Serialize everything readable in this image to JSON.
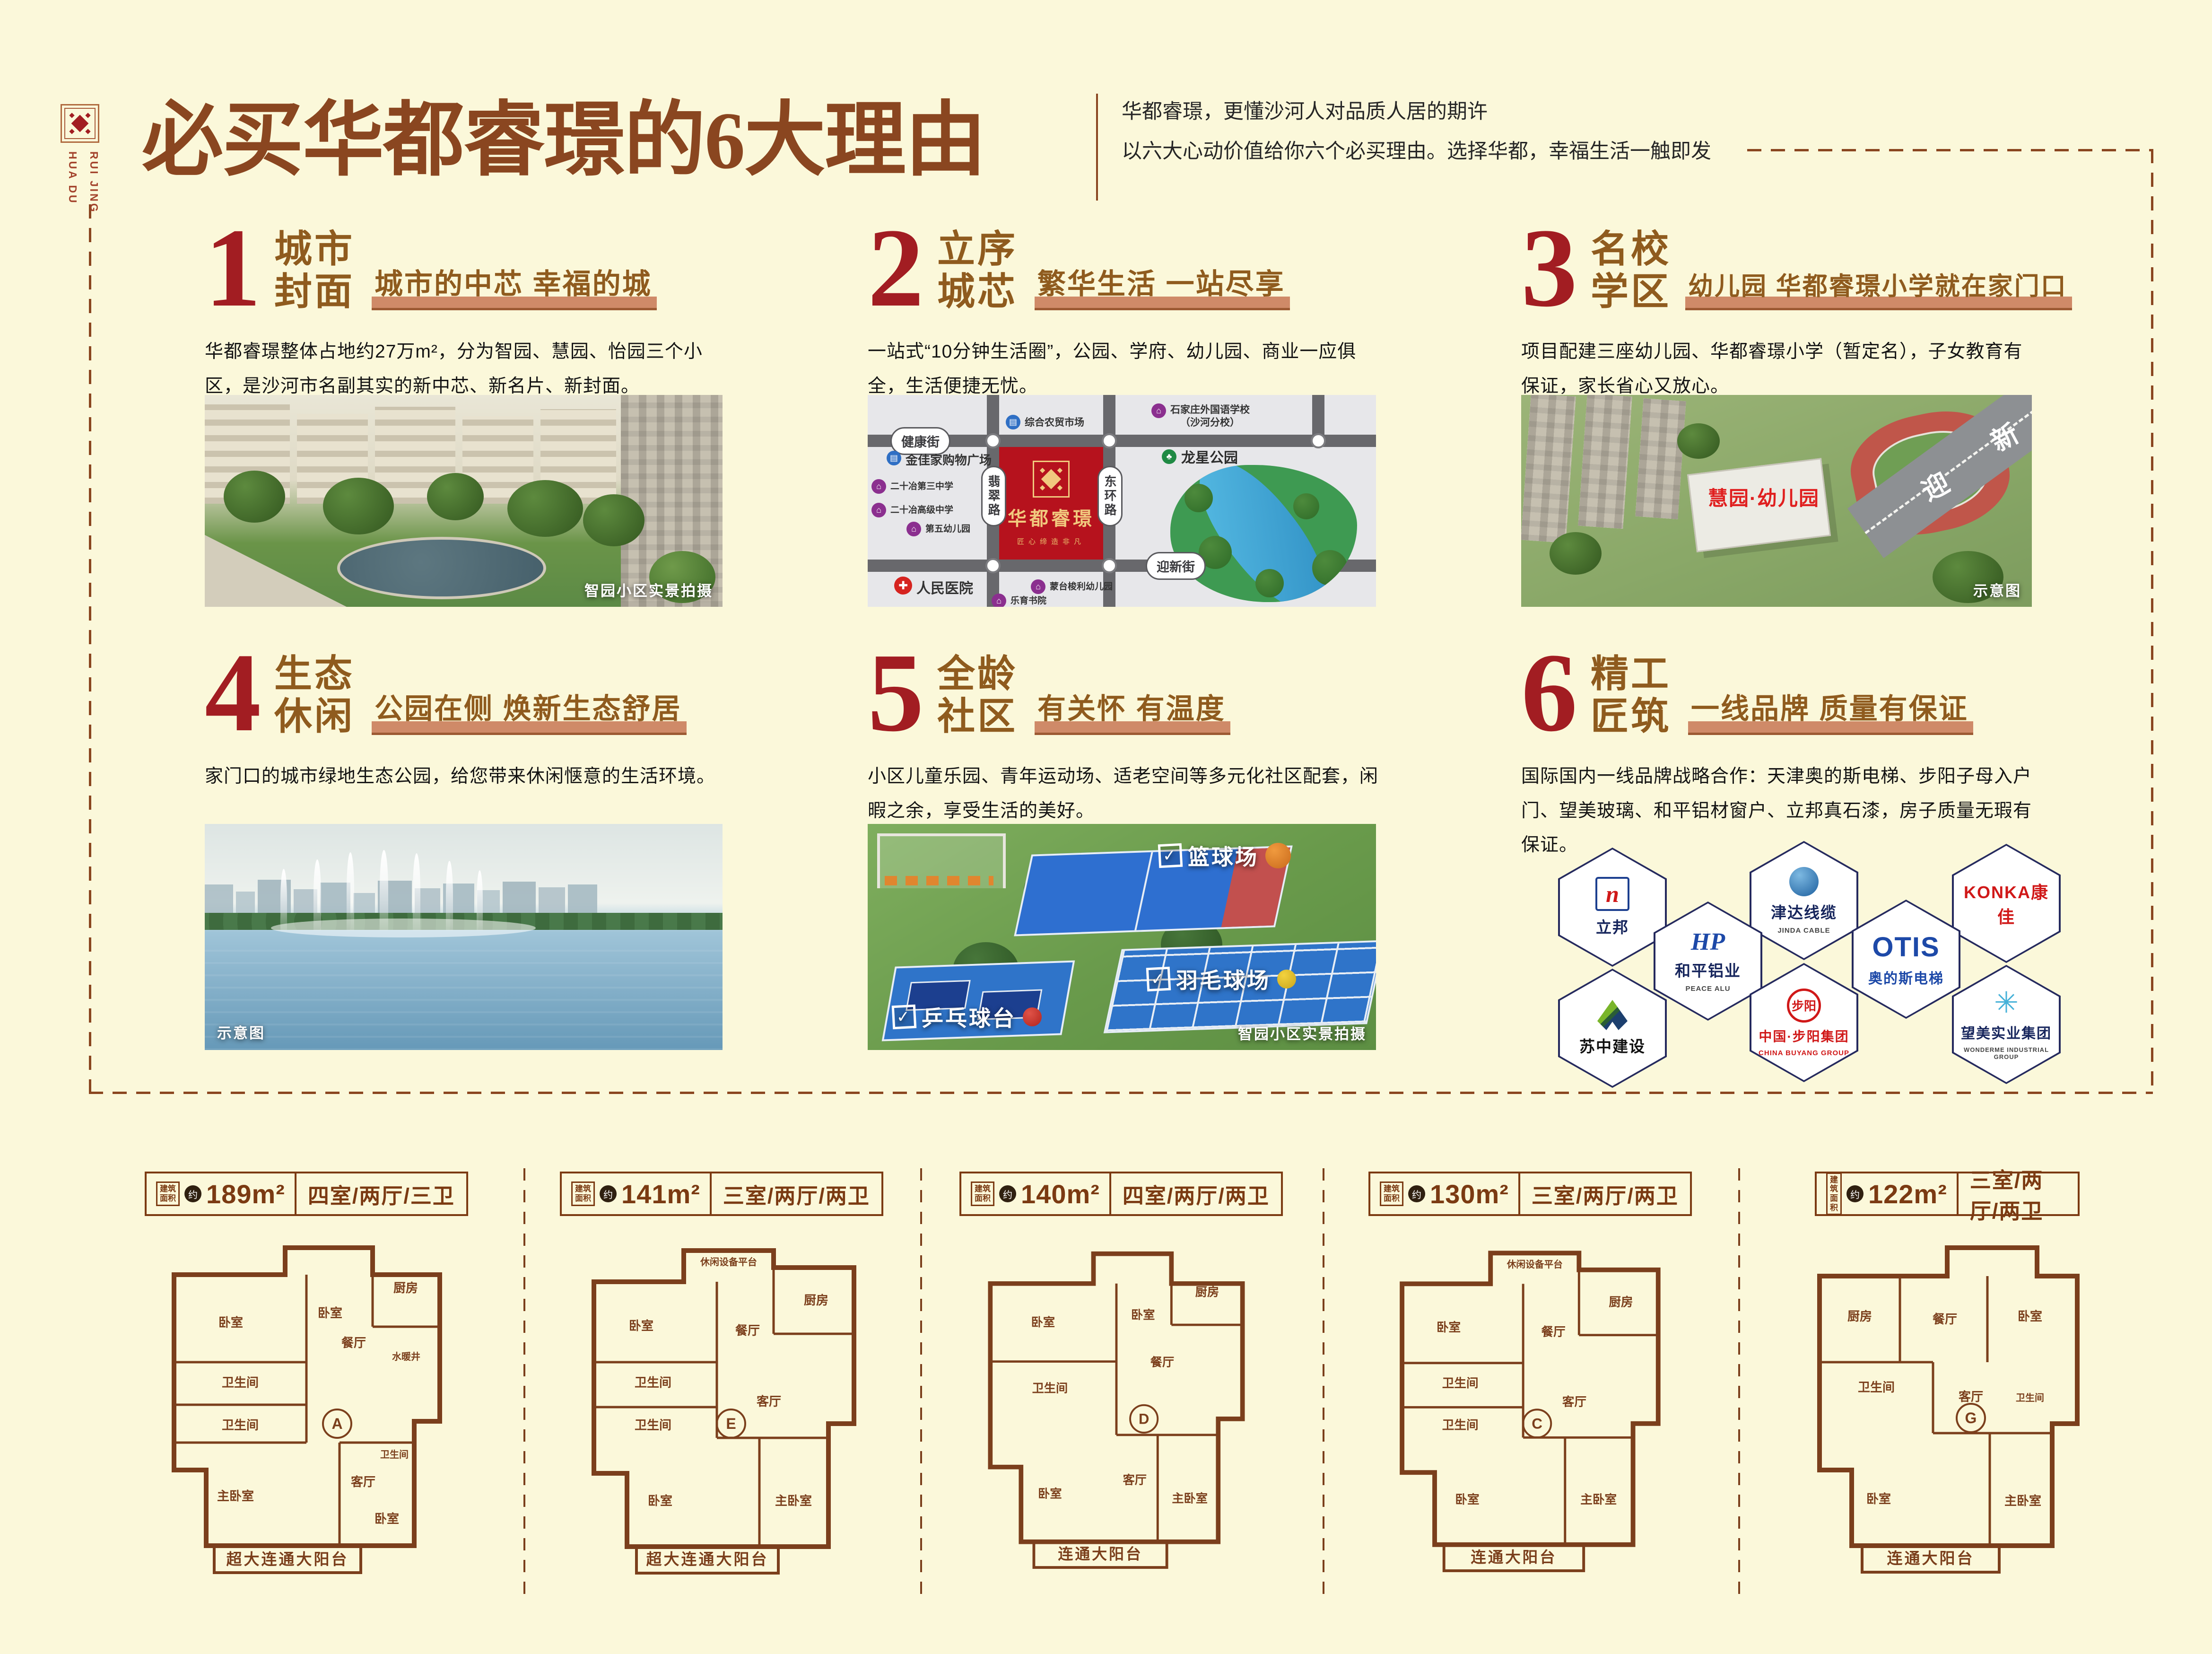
{
  "page": {
    "background": "#fbf8da"
  },
  "brand": {
    "emblem_icon": "huadu-emblem",
    "vertical_name_line1": "HUA DU",
    "vertical_name_line2": "RUI JING"
  },
  "header": {
    "title": "必买华都睿璟的6大理由",
    "subtitle_line1": "华都睿璟，更懂沙河人对品质人居的期许",
    "subtitle_line2": "以六大心动价值给你六个必买理由。选择华都，幸福生活一触即发"
  },
  "icons": {
    "market": "▤",
    "school": "⌂",
    "hospital": "✚",
    "park": "♣",
    "check": "✓"
  },
  "colors": {
    "accent_red": "#a21d22",
    "brown": "#8a4620",
    "gold_brown": "#8f5b1e",
    "bar_salmon": "#cf8a68",
    "map_red": "#b6121d",
    "plan_brown": "#7b3f1c"
  },
  "sections": [
    {
      "num": "1",
      "title1": "城市",
      "title2": "封面",
      "tagline": "城市的中芯 幸福的城",
      "body": "华都睿璟整体占地约27万m²，分为智园、慧园、怡园三个小区，是沙河市名副其实的新中芯、新名片、新封面。",
      "caption": "智园小区实景拍摄"
    },
    {
      "num": "2",
      "title1": "立序",
      "title2": "城芯",
      "tagline": "繁华生活 一站尽享",
      "body": "一站式“10分钟生活圈”，公园、学府、幼儿园、商业一应俱全，生活便捷无忧。"
    },
    {
      "num": "3",
      "title1": "名校",
      "title2": "学区",
      "tagline": "幼儿园 华都睿璟小学就在家门口",
      "body": "项目配建三座幼儿园、华都睿璟小学（暂定名），子女教育有保证，家长省心又放心。",
      "caption": "示意图",
      "building_label": "慧园·幼儿园",
      "road_char1": "迎",
      "road_char2": "新",
      "road_char3": "街"
    },
    {
      "num": "4",
      "title1": "生态",
      "title2": "休闲",
      "tagline": "公园在侧 焕新生态舒居",
      "body": "家门口的城市绿地生态公园，给您带来休闲惬意的生活环境。",
      "caption": "示意图"
    },
    {
      "num": "5",
      "title1": "全龄",
      "title2": "社区",
      "tagline": "有关怀 有温度",
      "body": "小区儿童乐园、青年运动场、适老空间等多元化社区配套，闲暇之余，享受生活的美好。",
      "caption": "智园小区实景拍摄",
      "court_labels": [
        "篮球场",
        "羽毛球场",
        "乒乓球台"
      ]
    },
    {
      "num": "6",
      "title1": "精工",
      "title2": "匠筑",
      "tagline": "一线品牌 质量有保证",
      "body": "国际国内一线品牌战略合作：天津奥的斯电梯、步阳子母入户门、望美玻璃、和平铝材窗户、立邦真石漆，房子质量无瑕有保证。"
    }
  ],
  "map": {
    "project_name": "华都睿璟",
    "project_slogan": "匠心缔造非凡",
    "road_top": "健康街",
    "road_bottom": "迎新街",
    "road_left": "翡翠路",
    "road_right": "东环路",
    "park_name": "龙星公园",
    "pois": [
      {
        "name": "综合农贸市场",
        "type": "market"
      },
      {
        "name": "石家庄外国语学校",
        "name2": "（沙河分校）",
        "type": "school"
      },
      {
        "name": "金佳家购物广场",
        "type": "market"
      },
      {
        "name": "二十冶第三中学",
        "type": "school"
      },
      {
        "name": "二十冶高级中学",
        "type": "school"
      },
      {
        "name": "第五幼儿园",
        "type": "school"
      },
      {
        "name": "人民医院",
        "type": "hospital"
      },
      {
        "name": "蒙台梭利幼儿园",
        "type": "school"
      },
      {
        "name": "乐育书院",
        "type": "school"
      }
    ]
  },
  "brands": [
    {
      "cn": "立邦",
      "logo": "n"
    },
    {
      "cn": "和平铝业",
      "en": "PEACE ALU",
      "logo": "HP"
    },
    {
      "cn": "津达线缆",
      "en": "JINDA CABLE"
    },
    {
      "cn": "OTIS",
      "cn2": "奥的斯电梯"
    },
    {
      "cn": "KONKA康佳"
    },
    {
      "cn": "苏中建设"
    },
    {
      "cn": "中国·步阳集团",
      "en": "CHINA BUYANG GROUP",
      "logo": "步阳"
    },
    {
      "cn": "望美实业集团",
      "en": "WONDERME INDUSTRIAL GROUP"
    }
  ],
  "floorplans": [
    {
      "area_label": "建筑\n面积",
      "approx": "约",
      "area": "189m²",
      "layout": "四室/两厅/三卫",
      "letter": "A",
      "balcony": "超大连通大阳台",
      "rooms": [
        "卧室",
        "卧室",
        "餐厅",
        "厨房",
        "水暖井",
        "卫生间",
        "卫生间",
        "主卧室",
        "客厅",
        "卫生间",
        "卧室"
      ]
    },
    {
      "area_label": "建筑\n面积",
      "approx": "约",
      "area": "141m²",
      "layout": "三室/两厅/两卫",
      "letter": "E",
      "balcony": "超大连通大阳台",
      "top_note": "休闲设备平台",
      "rooms": [
        "卧室",
        "餐厅",
        "厨房",
        "卫生间",
        "卫生间",
        "卧室",
        "客厅",
        "主卧室"
      ]
    },
    {
      "area_label": "建筑\n面积",
      "approx": "约",
      "area": "140m²",
      "layout": "四室/两厅/两卫",
      "letter": "D",
      "balcony": "连通大阳台",
      "rooms": [
        "卧室",
        "卧室",
        "餐厅",
        "厨房",
        "卫生间",
        "卧室",
        "客厅",
        "主卧室"
      ]
    },
    {
      "area_label": "建筑\n面积",
      "approx": "约",
      "area": "130m²",
      "layout": "三室/两厅/两卫",
      "letter": "C",
      "balcony": "连通大阳台",
      "top_note": "休闲设备平台",
      "rooms": [
        "卧室",
        "餐厅",
        "厨房",
        "卫生间",
        "卫生间",
        "卧室",
        "客厅",
        "主卧室"
      ]
    },
    {
      "area_label": "建筑\n面积",
      "approx": "约",
      "area": "122m²",
      "layout": "三室/两厅/两卫",
      "letter": "G",
      "balcony": "连通大阳台",
      "rooms": [
        "厨房",
        "餐厅",
        "卧室",
        "卫生间",
        "卫生间",
        "卧室",
        "客厅",
        "主卧室"
      ]
    }
  ]
}
